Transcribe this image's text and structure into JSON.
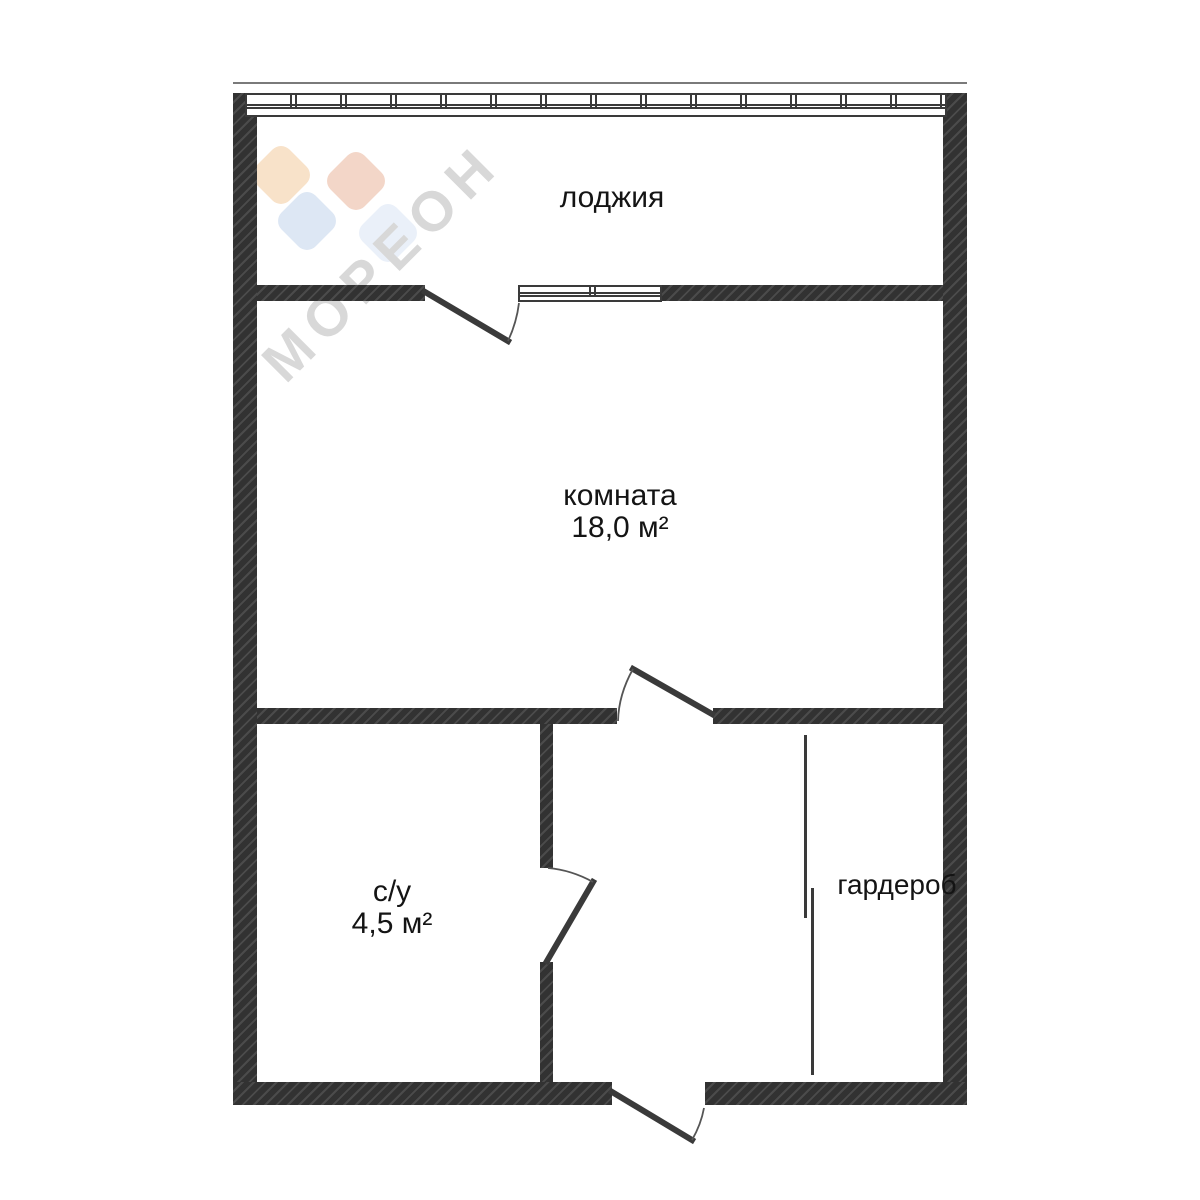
{
  "plan": {
    "watermark": {
      "text": "МОРЕОН"
    },
    "rooms": [
      {
        "name": "лоджия",
        "area": ""
      },
      {
        "name": "комната",
        "area": "18,0 м²"
      },
      {
        "name": "с/у",
        "area": "4,5 м²"
      },
      {
        "name": "гардероб",
        "area": ""
      }
    ],
    "colors": {
      "wall": "#323232",
      "wall_hatch": "#4b4b4b",
      "line": "#3a3a3a",
      "arc": "#555555",
      "text": "#141414",
      "watermark": "#d8d8d8",
      "logo_peach": "#f8e2c9",
      "logo_salmon": "#f3d6c8",
      "logo_blue": "#dde7f4",
      "logo_pale_blue": "#eaf0f9"
    }
  }
}
